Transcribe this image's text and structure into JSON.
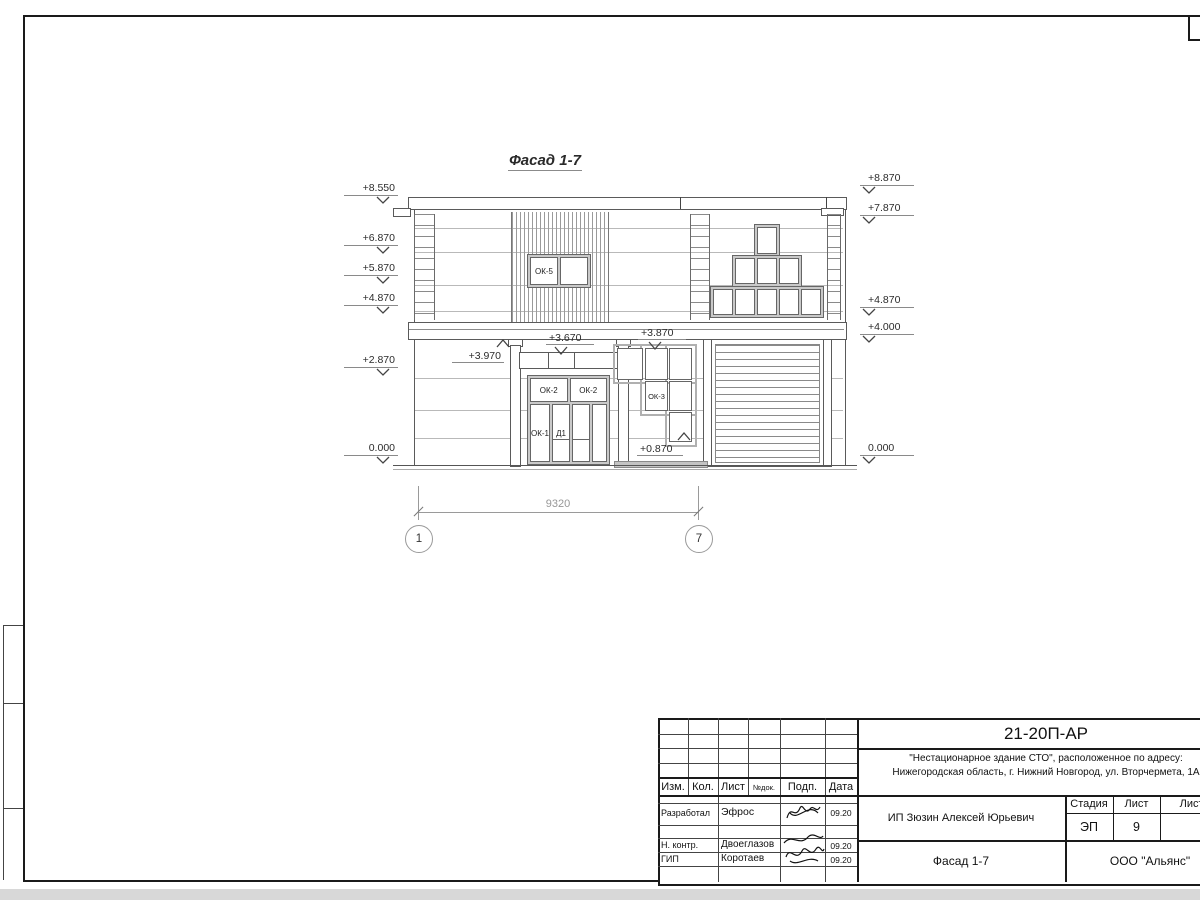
{
  "drawing": {
    "title": "Фасад 1-7",
    "elevation_marks_left": [
      "+8.550",
      "+6.870",
      "+5.870",
      "+4.870",
      "+2.870",
      "0.000"
    ],
    "elevation_marks_right": [
      "+8.870",
      "+7.870",
      "+4.870",
      "+4.000",
      "0.000"
    ],
    "callouts": [
      "+3.970",
      "+3.670",
      "+3.870",
      "+0.870"
    ],
    "labels": {
      "ok5": "ОК-5",
      "ok2_left": "ОК-2",
      "ok2_right": "ОК-2",
      "ok1": "ОК-1",
      "d1": "Д1",
      "ok3": "ОК-3"
    },
    "dimension_total": "9320",
    "axes": [
      "1",
      "7"
    ]
  },
  "titleblock": {
    "doc_number": "21-20П-АР",
    "project_line1": "\"Нестационарное здание СТО\", расположенное по адресу:",
    "project_line2": "Нижегородская область, г. Нижний Новгород, ул. Вторчермета, 1А",
    "client": "ИП Зюзин Алексей Юрьевич",
    "sheet_title": "Фасад 1-7",
    "company": "ООО \"Альянс\"",
    "header_cols": [
      "Изм.",
      "Кол.",
      "Лист",
      "№док.",
      "Подп.",
      "Дата"
    ],
    "stage_label": "Стадия",
    "sheet_label": "Лист",
    "sheets_label": "Листов",
    "stage": "ЭП",
    "sheet_no": "9",
    "rows": [
      {
        "role": "Разработал",
        "name": "Эфрос",
        "date": "09.20"
      },
      {
        "role": "Н. контр.",
        "name": "Двоеглазов",
        "date": "09.20"
      },
      {
        "role": "ГИП",
        "name": "Коротаев",
        "date": "09.20"
      }
    ]
  }
}
